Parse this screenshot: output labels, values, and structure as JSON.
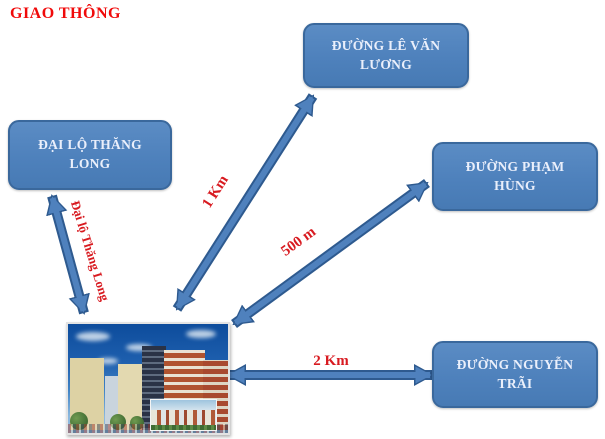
{
  "title": {
    "text": "GIAO THÔNG",
    "color": "#F00A0A"
  },
  "nodes": [
    {
      "id": "dai-lo-thang-long",
      "label": "ĐẠI LỘ THĂNG LONG"
    },
    {
      "id": "le-van-luong",
      "label": "ĐƯỜNG LÊ VĂN LƯƠNG"
    },
    {
      "id": "pham-hung",
      "label": "ĐƯỜNG PHẠM HÙNG"
    },
    {
      "id": "nguyen-trai",
      "label": "ĐƯỜNG NGUYỄN TRÃI"
    }
  ],
  "connections": [
    {
      "from": "building",
      "to": "dai-lo-thang-long",
      "label": "Đại lộ Thăng Long",
      "style": "double-arrow"
    },
    {
      "from": "building",
      "to": "le-van-luong",
      "label": "1 Km",
      "style": "double-arrow"
    },
    {
      "from": "building",
      "to": "pham-hung",
      "label": "500 m",
      "style": "double-arrow"
    },
    {
      "from": "building",
      "to": "nguyen-trai",
      "label": "2 Km",
      "style": "double-arrow"
    }
  ],
  "building_image": {
    "description": "apartment complex photo with inset rendering"
  },
  "colors": {
    "box_fill": "#4E81BC",
    "box_border": "#3A689C",
    "box_text": "#EAEFFB",
    "arrow_fill": "#4F81BD",
    "arrow_outline": "#2E5A8F",
    "label_red": "#D81A20",
    "title_red": "#F00A0A",
    "background": "#FFFFFF"
  }
}
